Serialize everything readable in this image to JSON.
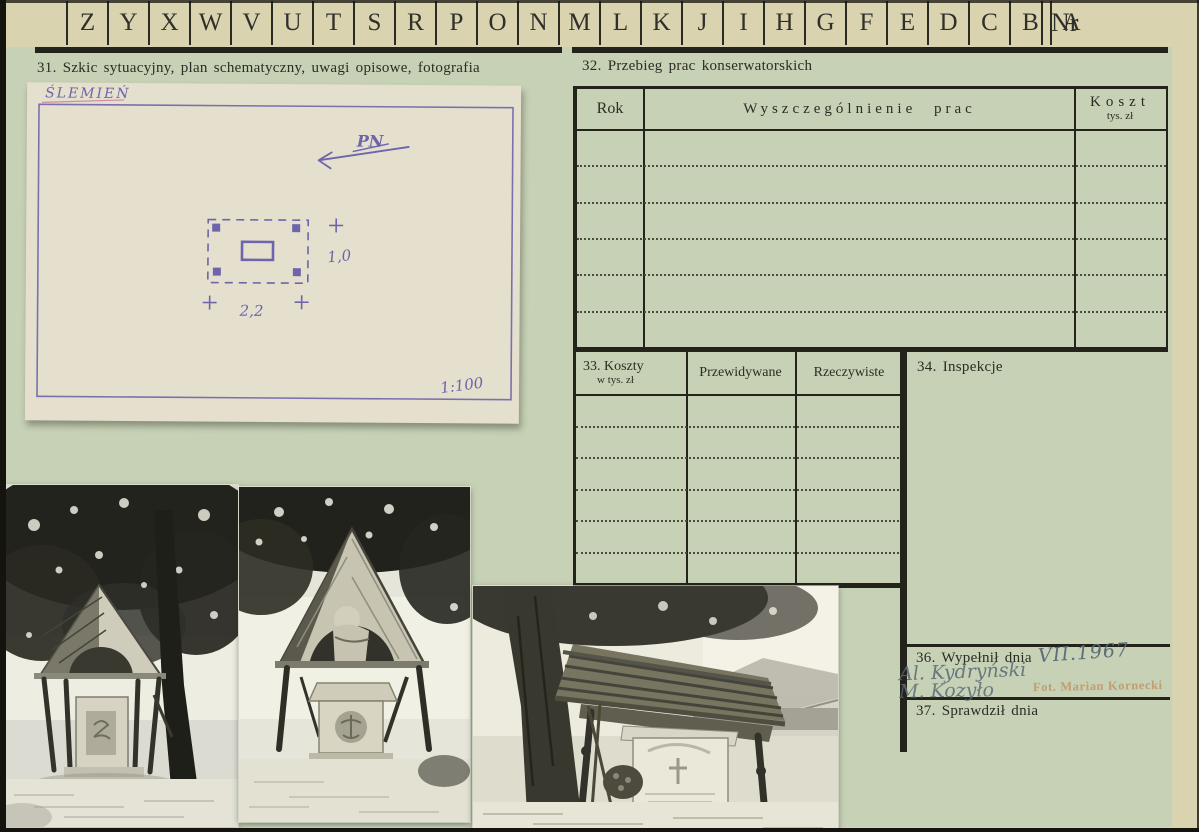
{
  "tab_strip": {
    "letters": [
      "Z",
      "Y",
      "X",
      "W",
      "V",
      "U",
      "T",
      "S",
      "R",
      "P",
      "O",
      "N",
      "M",
      "L",
      "K",
      "J",
      "I",
      "H",
      "G",
      "F",
      "E",
      "D",
      "C",
      "B",
      "A"
    ],
    "nr_label": "Nr"
  },
  "sections": {
    "s31": {
      "title": "31. Szkic sytuacyjny, plan schematyczny, uwagi opisowe, fotografia"
    },
    "s32": {
      "title": "32. Przebieg prac konserwatorskich",
      "columns": {
        "rok": "Rok",
        "prace": "Wyszczególnienie prac",
        "koszt": "Koszt",
        "koszt_unit": "tys. zł"
      }
    },
    "s33": {
      "title": "33. Koszty",
      "unit": "w tys. zł",
      "col_expected": "Przewidywane",
      "col_actual": "Rzeczywiste"
    },
    "s34": {
      "title": "34. Inspekcje"
    },
    "s36": {
      "title": "36. Wypełnił dnia",
      "date_handwritten": "VII.1967",
      "signature_line1": "Al. Kydryński",
      "signature_line2": "M. Kozyło",
      "photo_credit_stamp": "Fot. Marian Kornecki"
    },
    "s37": {
      "title": "37. Sprawdził dnia"
    }
  },
  "sketch": {
    "place": "ŚLEMIEŃ",
    "north": "PN",
    "dim_right": "1,0",
    "dim_bottom": "2,2",
    "scale": "1:100"
  },
  "photos": [
    {
      "alt": "Drewniana kapliczka pod drzewem — widok frontalny"
    },
    {
      "alt": "Drewniana kapliczka z rzeźbą — zbliżenie"
    },
    {
      "alt": "Drewniana kapliczka przy drodze — widok boczny"
    }
  ],
  "colors": {
    "card_cream": "#d9d3af",
    "panel_green": "#c6d1b5",
    "print_line": "#23231c",
    "sketch_ink_purple": "#6e64ab",
    "handwriting_pencil": "#5d6e79",
    "stamp_orange": "#be7e42"
  }
}
